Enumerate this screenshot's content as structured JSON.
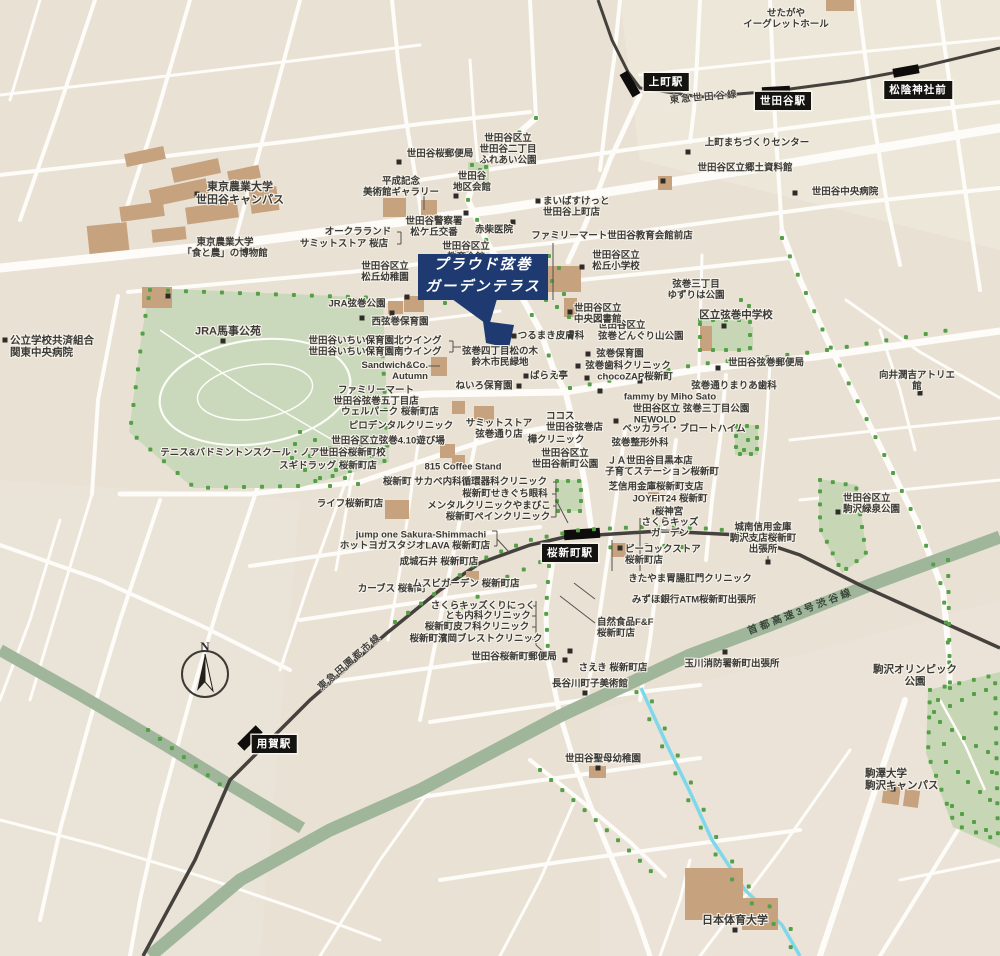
{
  "property_callout": {
    "line1": "プラウド弦巻",
    "line2": "ガーデンテラス"
  },
  "compass": {
    "label": "N"
  },
  "colors": {
    "background": "#e9e1d4",
    "road": "#fdfcf9",
    "park": "#c7d6b5",
    "tree": "#55a047",
    "railway": "#45423d",
    "highway_band": "#9fb69b",
    "stream": "#7fd8ea",
    "building": "#c6a37e",
    "callout_navy": "#1e3a70",
    "label_text": "#3b3a36",
    "station_bg": "#14130f",
    "station_text": "#ffffff"
  },
  "stations": [
    {
      "id": "kamimachi",
      "name": "上町駅",
      "x": 666,
      "y": 82
    },
    {
      "id": "setagaya",
      "name": "世田谷駅",
      "x": 783,
      "y": 101
    },
    {
      "id": "shoin-jinja-mae",
      "name": "松陰神社前",
      "x": 918,
      "y": 90
    },
    {
      "id": "sakura-shinmachi",
      "name": "桜新町駅",
      "x": 570,
      "y": 553
    },
    {
      "id": "yoga",
      "name": "用賀駅",
      "x": 274,
      "y": 744
    }
  ],
  "railway_labels": [
    {
      "text": "東急世田谷線",
      "x": 704,
      "y": 96,
      "rotate": -5,
      "kind": "rail"
    },
    {
      "text": "東急田園都市線",
      "x": 349,
      "y": 661,
      "rotate": -41,
      "kind": "rail"
    },
    {
      "text": "首都高速3号渋谷線",
      "x": 800,
      "y": 610,
      "rotate": -21,
      "kind": "hwy"
    }
  ],
  "labels": [
    {
      "t": "せたがや\nイーグレットホール",
      "x": 786,
      "y": 19
    },
    {
      "t": "上町まちづくりセンター",
      "x": 757,
      "y": 143,
      "dot": [
        688,
        152
      ]
    },
    {
      "t": "世田谷区立郷土資料館",
      "x": 745,
      "y": 168,
      "dot": [
        663,
        181
      ]
    },
    {
      "t": "世田谷中央病院",
      "x": 845,
      "y": 192,
      "dot": [
        795,
        193
      ]
    },
    {
      "t": "世田谷桜郵便局",
      "x": 440,
      "y": 154,
      "dot": [
        399,
        162
      ]
    },
    {
      "t": "平成記念\n美術館ギャラリー",
      "x": 401,
      "y": 187
    },
    {
      "t": "世田谷\n地区会館",
      "x": 472,
      "y": 182,
      "dot": [
        456,
        196
      ]
    },
    {
      "t": "世田谷区立\n世田谷二丁目\nふれあい公園",
      "x": 508,
      "y": 150
    },
    {
      "t": "まいばすけっと\n世田谷上町店",
      "x": 543,
      "y": 207,
      "a": "l",
      "dot": [
        538,
        201
      ]
    },
    {
      "t": "世田谷警察署\n松ケ丘交番",
      "x": 434,
      "y": 227,
      "dot": [
        466,
        213
      ]
    },
    {
      "t": "赤柴医院",
      "x": 494,
      "y": 230,
      "dot": [
        513,
        222
      ]
    },
    {
      "t": "ファミリーマート世田谷教育会館前店",
      "x": 612,
      "y": 236
    },
    {
      "t": "東京農業大学\n世田谷キャンパス",
      "x": 240,
      "y": 194,
      "fs": 11,
      "dot": [
        197,
        194
      ]
    },
    {
      "t": "東京農業大学\n「食と農」の博物館",
      "x": 225,
      "y": 248,
      "dot": [
        168,
        296
      ]
    },
    {
      "t": "オークラランド",
      "x": 358,
      "y": 232
    },
    {
      "t": "サミットストア 桜店",
      "x": 344,
      "y": 244
    },
    {
      "t": "世田谷区立\n教育会館",
      "x": 466,
      "y": 252
    },
    {
      "t": "世田谷区立\n松丘幼稚園",
      "x": 385,
      "y": 272,
      "dot": [
        407,
        297
      ]
    },
    {
      "t": "JRA弦巻公園",
      "x": 357,
      "y": 304,
      "dot": [
        392,
        313
      ]
    },
    {
      "t": "西弦巻保育園",
      "x": 400,
      "y": 322,
      "dot": [
        362,
        318
      ]
    },
    {
      "t": "世田谷いちい保育園北ウイング",
      "x": 375,
      "y": 341
    },
    {
      "t": "世田谷いちい保育園南ウイング",
      "x": 375,
      "y": 352
    },
    {
      "t": "Sandwich&Co.\nAutumn",
      "x": 428,
      "y": 371,
      "a": "r"
    },
    {
      "t": "ファミリーマート\n世田谷弦巻五丁目店",
      "x": 376,
      "y": 396
    },
    {
      "t": "ウェルパーク 桜新町店",
      "x": 390,
      "y": 412
    },
    {
      "t": "ピロデンタルクリニック",
      "x": 401,
      "y": 426
    },
    {
      "t": "世田谷区立弦巻4.10遊び場",
      "x": 388,
      "y": 441
    },
    {
      "t": "テニス&バドミントンスクール・ノア世田谷桜新町校",
      "x": 273,
      "y": 453
    },
    {
      "t": "スギドラッグ 桜新町店",
      "x": 328,
      "y": 466
    },
    {
      "t": "815 Coffee Stand",
      "x": 463,
      "y": 467
    },
    {
      "t": "ライフ桜新町店",
      "x": 350,
      "y": 504
    },
    {
      "t": "桜新町 サカベ内科循環器科クリニック",
      "x": 465,
      "y": 482
    },
    {
      "t": "桜新町せきぐち眼科",
      "x": 505,
      "y": 494
    },
    {
      "t": "メンタルクリニックやまびこ",
      "x": 489,
      "y": 506
    },
    {
      "t": "桜新町ペインクリニック",
      "x": 498,
      "y": 517
    },
    {
      "t": "jump one Sakura-Shimmachi",
      "x": 421,
      "y": 535
    },
    {
      "t": "ホットヨガスタジオLAVA 桜新町店",
      "x": 415,
      "y": 546
    },
    {
      "t": "成城石井 桜新町店",
      "x": 439,
      "y": 562
    },
    {
      "t": "カーブス 桜新町",
      "x": 392,
      "y": 589
    },
    {
      "t": "ムスビガーデン 桜新町店",
      "x": 466,
      "y": 584
    },
    {
      "t": "さくらキッズくりにっく",
      "x": 483,
      "y": 606
    },
    {
      "t": "とも内科クリニック",
      "x": 488,
      "y": 616
    },
    {
      "t": "桜新町皮フ科クリニック",
      "x": 477,
      "y": 627
    },
    {
      "t": "桜新町濱岡ブレストクリニック",
      "x": 476,
      "y": 639
    },
    {
      "t": "世田谷桜新町郵便局",
      "x": 514,
      "y": 657,
      "dot": [
        570,
        651
      ]
    },
    {
      "t": "世田谷区立\n世田谷新町公園",
      "x": 565,
      "y": 459
    },
    {
      "t": "桜神宮",
      "x": 669,
      "y": 512,
      "dot": [
        655,
        512
      ]
    },
    {
      "t": "さくらキッズ\nガーデン",
      "x": 670,
      "y": 528
    },
    {
      "t": "ピーコックストア\n桜新町店",
      "x": 625,
      "y": 555,
      "a": "l",
      "dot": [
        620,
        548
      ]
    },
    {
      "t": "きたやま胃腸肛門クリニック",
      "x": 690,
      "y": 579
    },
    {
      "t": "みずほ銀行ATM桜新町出張所",
      "x": 694,
      "y": 600
    },
    {
      "t": "自然食品F&F\n桜新町店",
      "x": 597,
      "y": 628,
      "a": "l"
    },
    {
      "t": "さえき 桜新町店",
      "x": 613,
      "y": 668,
      "dot": [
        565,
        660
      ]
    },
    {
      "t": "長谷川町子美術館",
      "x": 590,
      "y": 684,
      "dot": [
        585,
        693
      ]
    },
    {
      "t": "玉川消防署新町出張所",
      "x": 732,
      "y": 664,
      "dot": [
        725,
        652
      ]
    },
    {
      "t": "世田谷聖母幼稚園",
      "x": 603,
      "y": 759,
      "dot": [
        598,
        768
      ]
    },
    {
      "t": "駒沢オリンピック公園",
      "x": 915,
      "y": 676,
      "fs": 10.5
    },
    {
      "t": "駒澤大学\n駒沢キャンパス",
      "x": 865,
      "y": 780,
      "a": "l",
      "fs": 10.5,
      "dot": [
        893,
        789
      ]
    },
    {
      "t": "日本体育大学",
      "x": 735,
      "y": 921,
      "fs": 11,
      "dot": [
        735,
        930
      ]
    },
    {
      "t": "城南信用金庫\n駒沢支店桜新町\n出張所",
      "x": 763,
      "y": 539,
      "dot": [
        768,
        562
      ]
    },
    {
      "t": "世田谷区立\n駒沢緑泉公園",
      "x": 843,
      "y": 504,
      "a": "l",
      "dot": [
        838,
        512
      ]
    },
    {
      "t": "向井潤吉アトリエ館",
      "x": 917,
      "y": 381,
      "dot": [
        920,
        393
      ]
    },
    {
      "t": "世田谷弦巻郵便局",
      "x": 766,
      "y": 363,
      "dot": [
        718,
        368
      ]
    },
    {
      "t": "区立弦巻中学校",
      "x": 736,
      "y": 315,
      "fs": 10.5,
      "dot": [
        724,
        326
      ]
    },
    {
      "t": "弦巻通りまりあ歯科",
      "x": 734,
      "y": 386,
      "dot": [
        640,
        381
      ]
    },
    {
      "t": "fammy by Miho Sato",
      "x": 670,
      "y": 397,
      "dot": [
        600,
        391
      ]
    },
    {
      "t": "世田谷区立 弦巻三丁目公園",
      "x": 691,
      "y": 409
    },
    {
      "t": "NEWOLD",
      "x": 655,
      "y": 420,
      "dot": [
        616,
        421
      ]
    },
    {
      "t": "ベッカライ・ブロートハイム",
      "x": 684,
      "y": 429
    },
    {
      "t": "弦巻整形外科",
      "x": 640,
      "y": 443
    },
    {
      "t": "ＪＡ世田谷目黒本店",
      "x": 650,
      "y": 461
    },
    {
      "t": "子育てステーション桜新町",
      "x": 662,
      "y": 472
    },
    {
      "t": "芝信用金庫桜新町支店",
      "x": 656,
      "y": 487
    },
    {
      "t": "JOYFIT24 桜新町",
      "x": 670,
      "y": 499
    },
    {
      "t": "世田谷区立\n弦巻どんぐり山公園",
      "x": 598,
      "y": 331,
      "a": "l"
    },
    {
      "t": "弦巻保育園",
      "x": 620,
      "y": 354,
      "dot": [
        588,
        354
      ]
    },
    {
      "t": "弦巻歯科クリニック",
      "x": 628,
      "y": 366,
      "dot": [
        578,
        366
      ]
    },
    {
      "t": "chocoZAP桜新町",
      "x": 635,
      "y": 377,
      "dot": [
        587,
        378
      ]
    },
    {
      "t": "つるまき皮膚科",
      "x": 551,
      "y": 336,
      "dot": [
        514,
        336
      ]
    },
    {
      "t": "弦巻四丁目松の木\n鈴木市民緑地",
      "x": 500,
      "y": 357
    },
    {
      "t": "ばらえ亭",
      "x": 549,
      "y": 376,
      "dot": [
        526,
        376
      ]
    },
    {
      "t": "ねいろ保育園",
      "x": 484,
      "y": 386,
      "dot": [
        519,
        386
      ]
    },
    {
      "t": "世田谷区立\n中央図書館",
      "x": 574,
      "y": 314,
      "a": "l",
      "dot": [
        570,
        312
      ]
    },
    {
      "t": "世田谷区立\n松丘小学校",
      "x": 616,
      "y": 261,
      "dot": [
        582,
        267
      ]
    },
    {
      "t": "弦巻三丁目\nゆずりは公園",
      "x": 696,
      "y": 290
    },
    {
      "t": "JRA馬事公苑",
      "x": 228,
      "y": 332,
      "fs": 11,
      "dot": [
        223,
        341
      ]
    },
    {
      "t": "公立学校共済組合\n関東中央病院",
      "x": 10,
      "y": 347,
      "a": "l",
      "fs": 10.5,
      "dot": [
        5,
        340
      ]
    },
    {
      "t": "ココス\n世田谷弦巻店",
      "x": 546,
      "y": 422,
      "a": "l"
    },
    {
      "t": "樺クリニック",
      "x": 556,
      "y": 440
    },
    {
      "t": "サミットストア\n弦巻通り店",
      "x": 499,
      "y": 429
    }
  ]
}
